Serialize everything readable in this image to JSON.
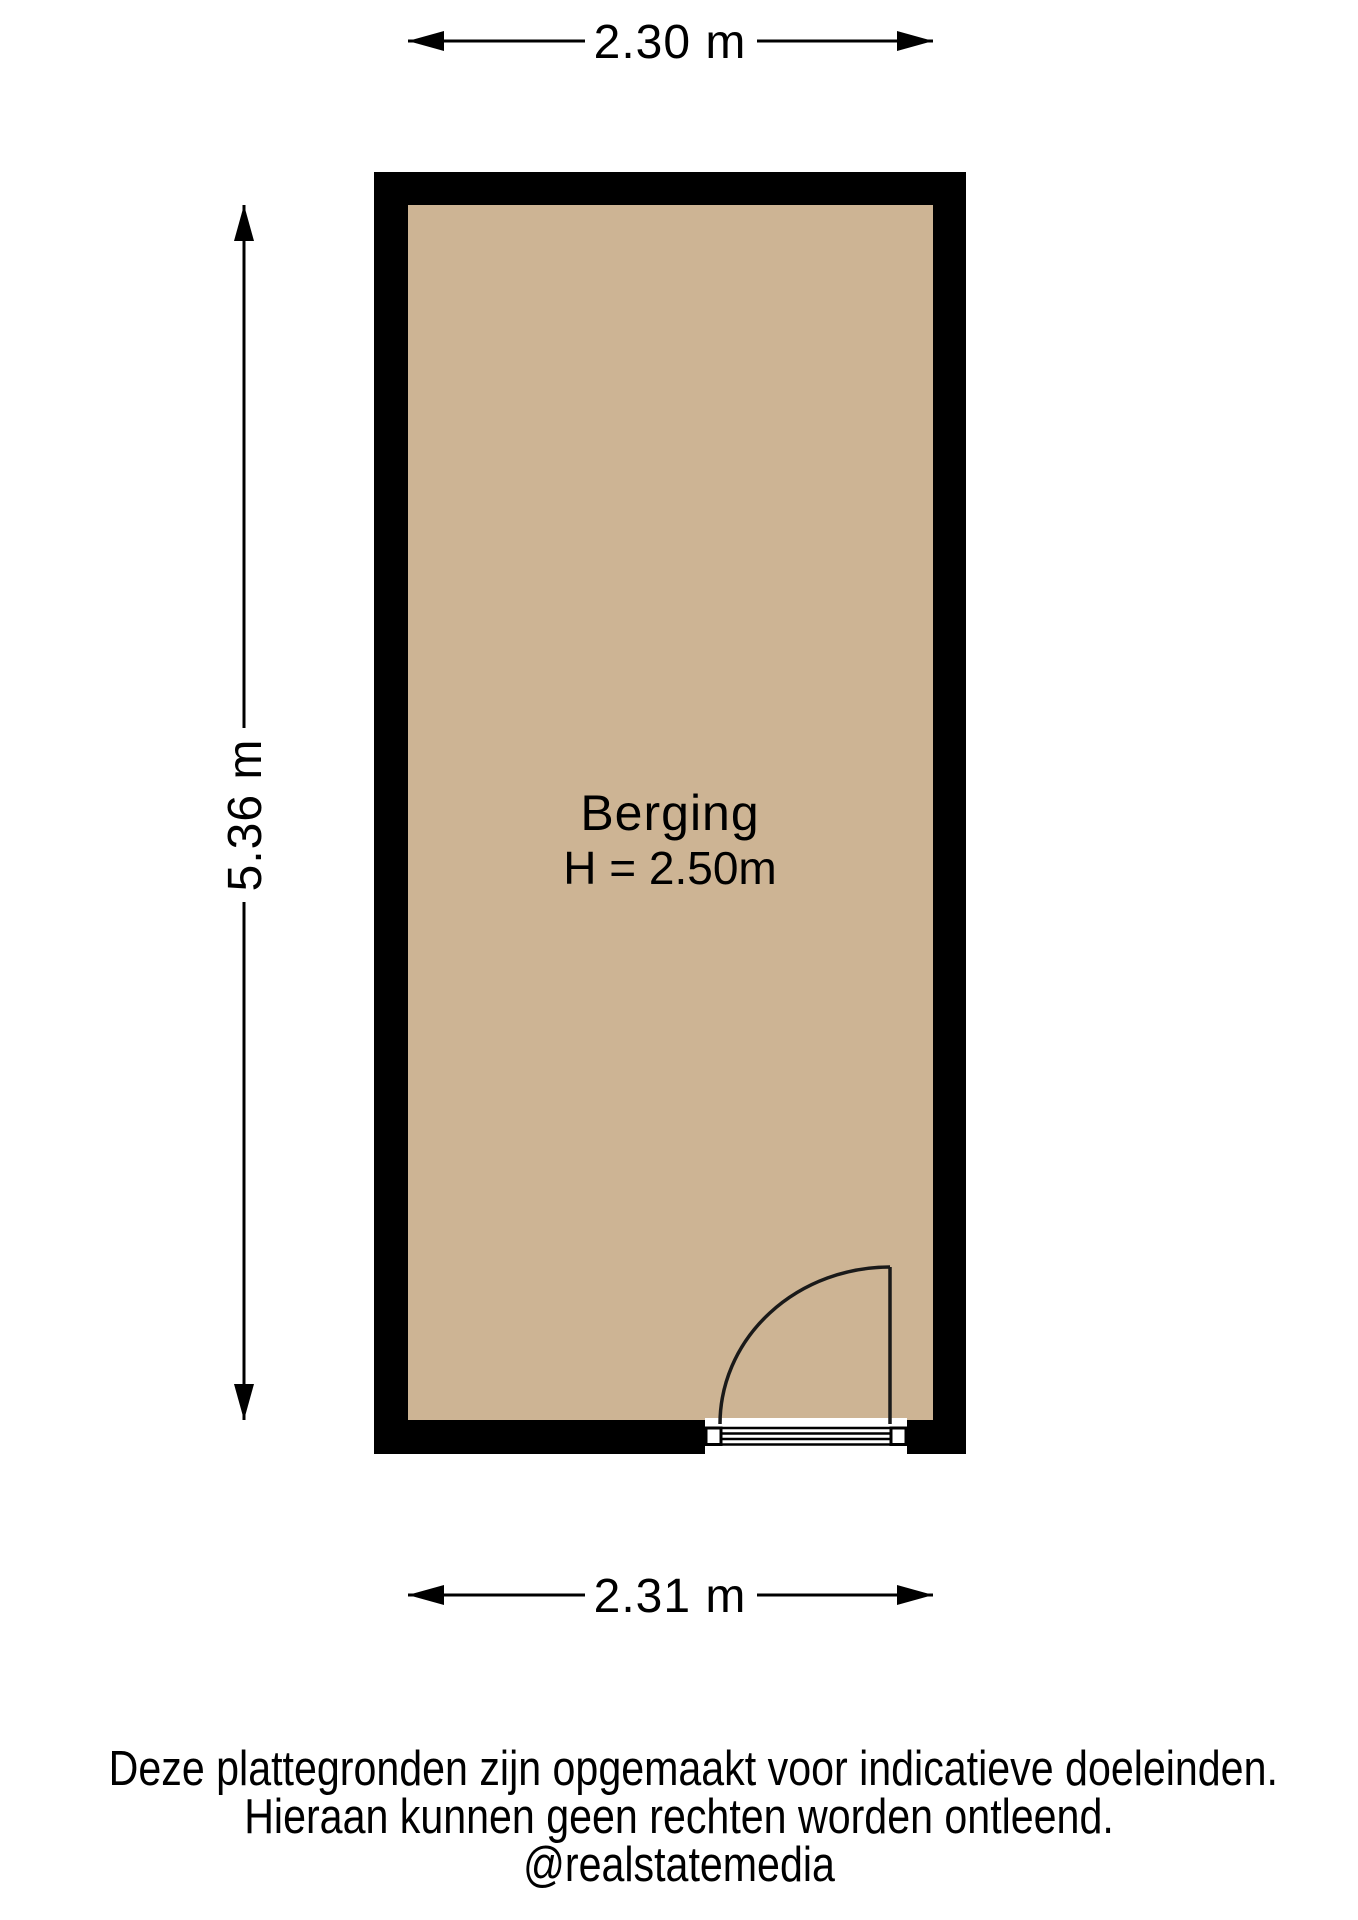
{
  "floorplan": {
    "room": {
      "label": "Berging",
      "height_label": "H = 2.50m",
      "floor_color": "#cdb494",
      "wall_color": "#000000"
    },
    "dimensions": {
      "width_top": "2.30 m",
      "height_left": "5.36 m",
      "width_bottom": "2.31 m"
    }
  },
  "footer": {
    "line1": "Deze plattegronden zijn opgemaakt voor indicatieve doeleinden.",
    "line2": "Hieraan kunnen geen rechten worden ontleend.",
    "line3": "@realstatemedia"
  }
}
